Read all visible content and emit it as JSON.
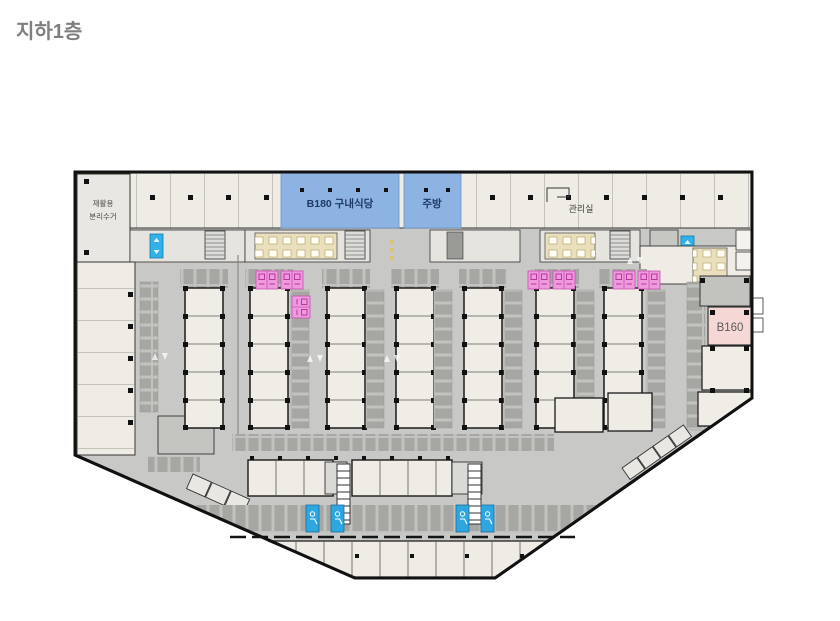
{
  "title": "지하1층",
  "plan": {
    "cafeteria_label": "B180 구내식당",
    "kitchen_label": "주방",
    "admin_label": "관리실",
    "recycle_label_line1": "재활용",
    "recycle_label_line2": "분리수거",
    "unit_b160_label": "B160",
    "colors": {
      "title_text": "#7f7f7f",
      "wall": "#1b1b1b",
      "parking_floor": "#c8c8c6",
      "room_fill": "#efece6",
      "stall_gray": "#a6a6a3",
      "food_zone_blue": "#8db3e2",
      "unit_b160_pink": "#f5d8d6",
      "women_parking_pink": "#f09ade",
      "accessible_parking_blue": "#2ea7e0",
      "elevator_blue": "#2fb3e8",
      "restroom_beige": "#e9dfbd"
    }
  }
}
